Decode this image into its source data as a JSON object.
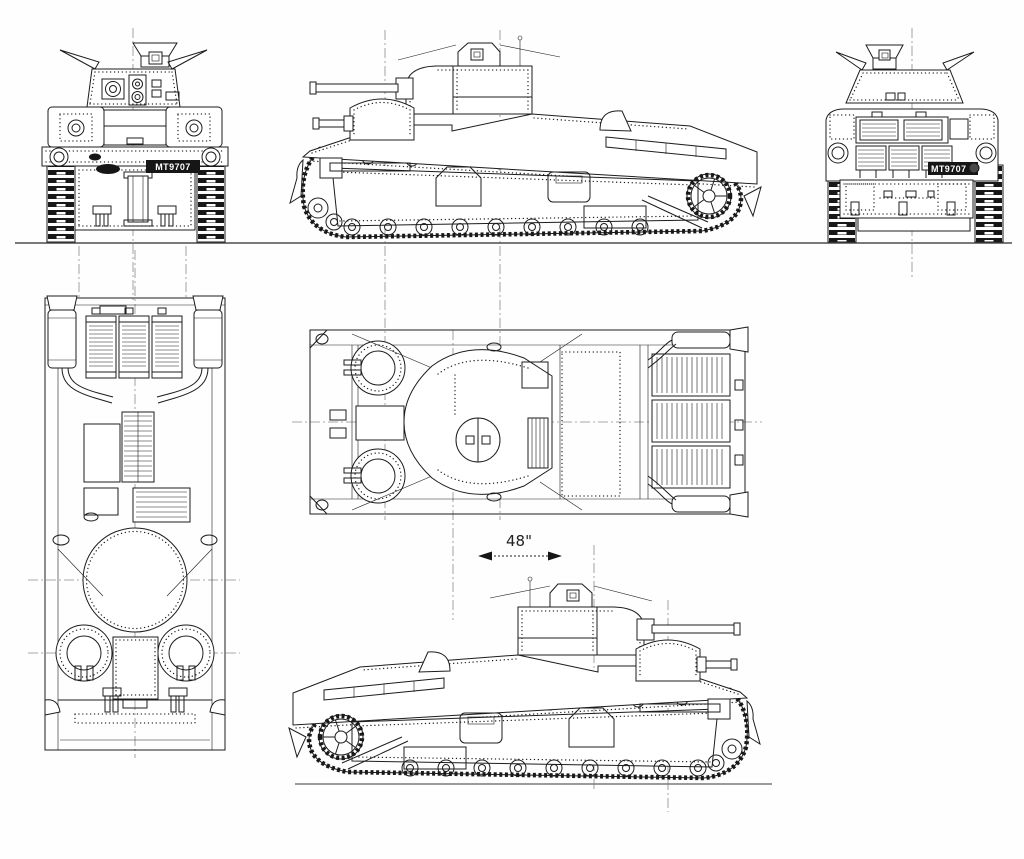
{
  "meta": {
    "type": "five-view technical blueprint line drawing of an interwar British medium tank",
    "background": "#ffffff",
    "ink_color": "#1c1c1c",
    "reference_line_color": "#8c8c8c",
    "ground_line_color": "#4d4d4d",
    "plate_background": "#161616",
    "plate_text_color": "#ffffff"
  },
  "labels": {
    "front_number_plate": "MT9707",
    "rear_number_plate": "MT9707",
    "track_gauge_dimension": "48\""
  },
  "views": [
    {
      "id": "front-view",
      "position": "top-left"
    },
    {
      "id": "left-side-view",
      "position": "top-center"
    },
    {
      "id": "rear-view",
      "position": "top-right"
    },
    {
      "id": "plan-view-rotated",
      "position": "middle-left",
      "orientation": "front facing down"
    },
    {
      "id": "plan-view",
      "position": "middle-center",
      "orientation": "front facing left"
    },
    {
      "id": "right-side-view",
      "position": "bottom-center"
    }
  ]
}
